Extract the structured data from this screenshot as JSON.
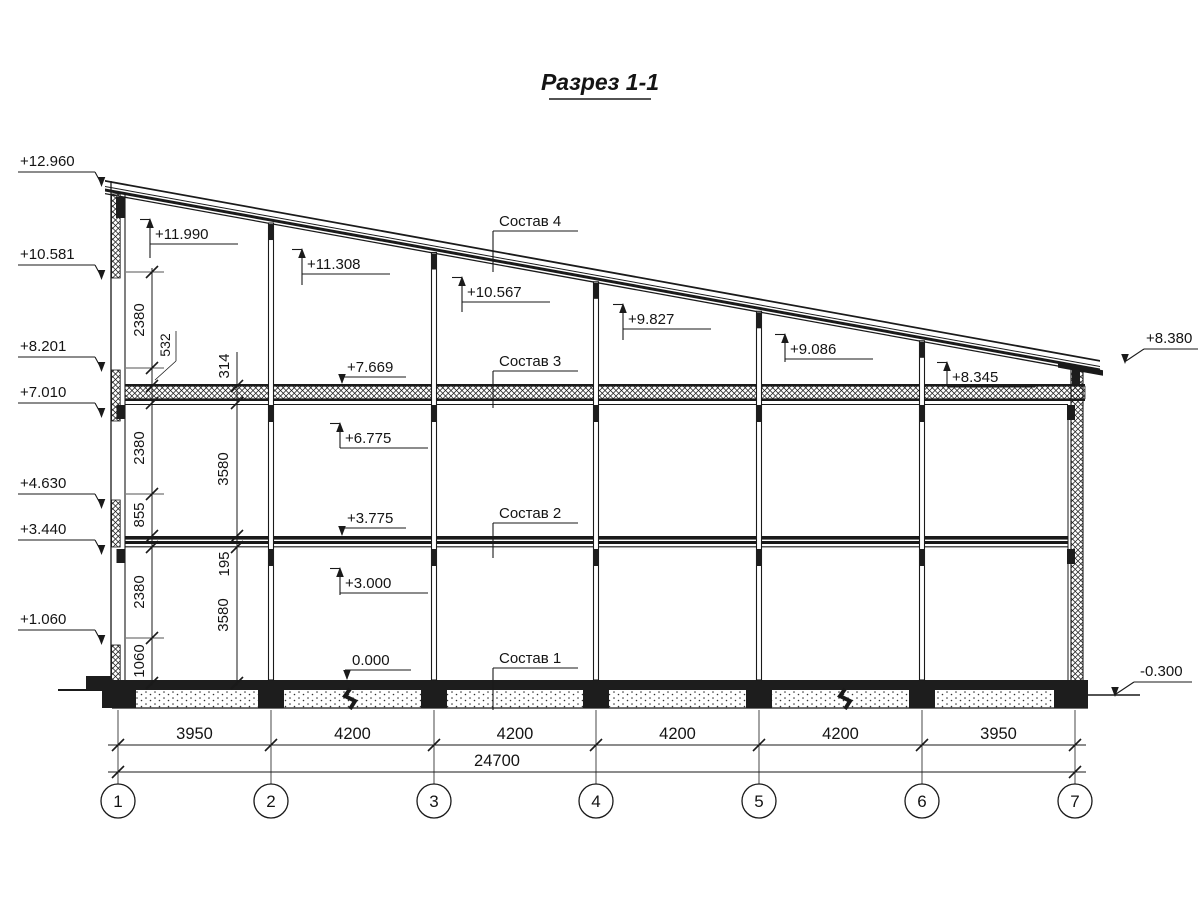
{
  "title": "Разрез 1-1",
  "elevations_left": [
    "+12.960",
    "+10.581",
    "+8.201",
    "+7.010",
    "+4.630",
    "+3.440",
    "+1.060"
  ],
  "elevations_right": [
    "+8.380",
    "-0.300"
  ],
  "elevations_interior_up": [
    "+11.990",
    "+11.308",
    "+10.567",
    "+9.827",
    "+9.086",
    "+8.345",
    "+6.775",
    "+3.000"
  ],
  "elevations_interior_down": [
    "+7.669",
    "+3.775",
    "0.000"
  ],
  "composition_labels": [
    "Состав 4",
    "Состав 3",
    "Состав 2",
    "Состав 1"
  ],
  "vertical_dims_wall": [
    "2380",
    "532",
    "2380",
    "855",
    "2380",
    "1060"
  ],
  "vertical_dims_inner": [
    "314",
    "3580",
    "195",
    "3580"
  ],
  "horizontal_spans": [
    "3950",
    "4200",
    "4200",
    "4200",
    "4200",
    "3950"
  ],
  "total_span": "24700",
  "axis_labels": [
    "1",
    "2",
    "3",
    "4",
    "5",
    "6",
    "7"
  ],
  "line_color": "#1a1a1a",
  "fill_dark": "#1d1d1d",
  "paper_color": "#ffffff"
}
